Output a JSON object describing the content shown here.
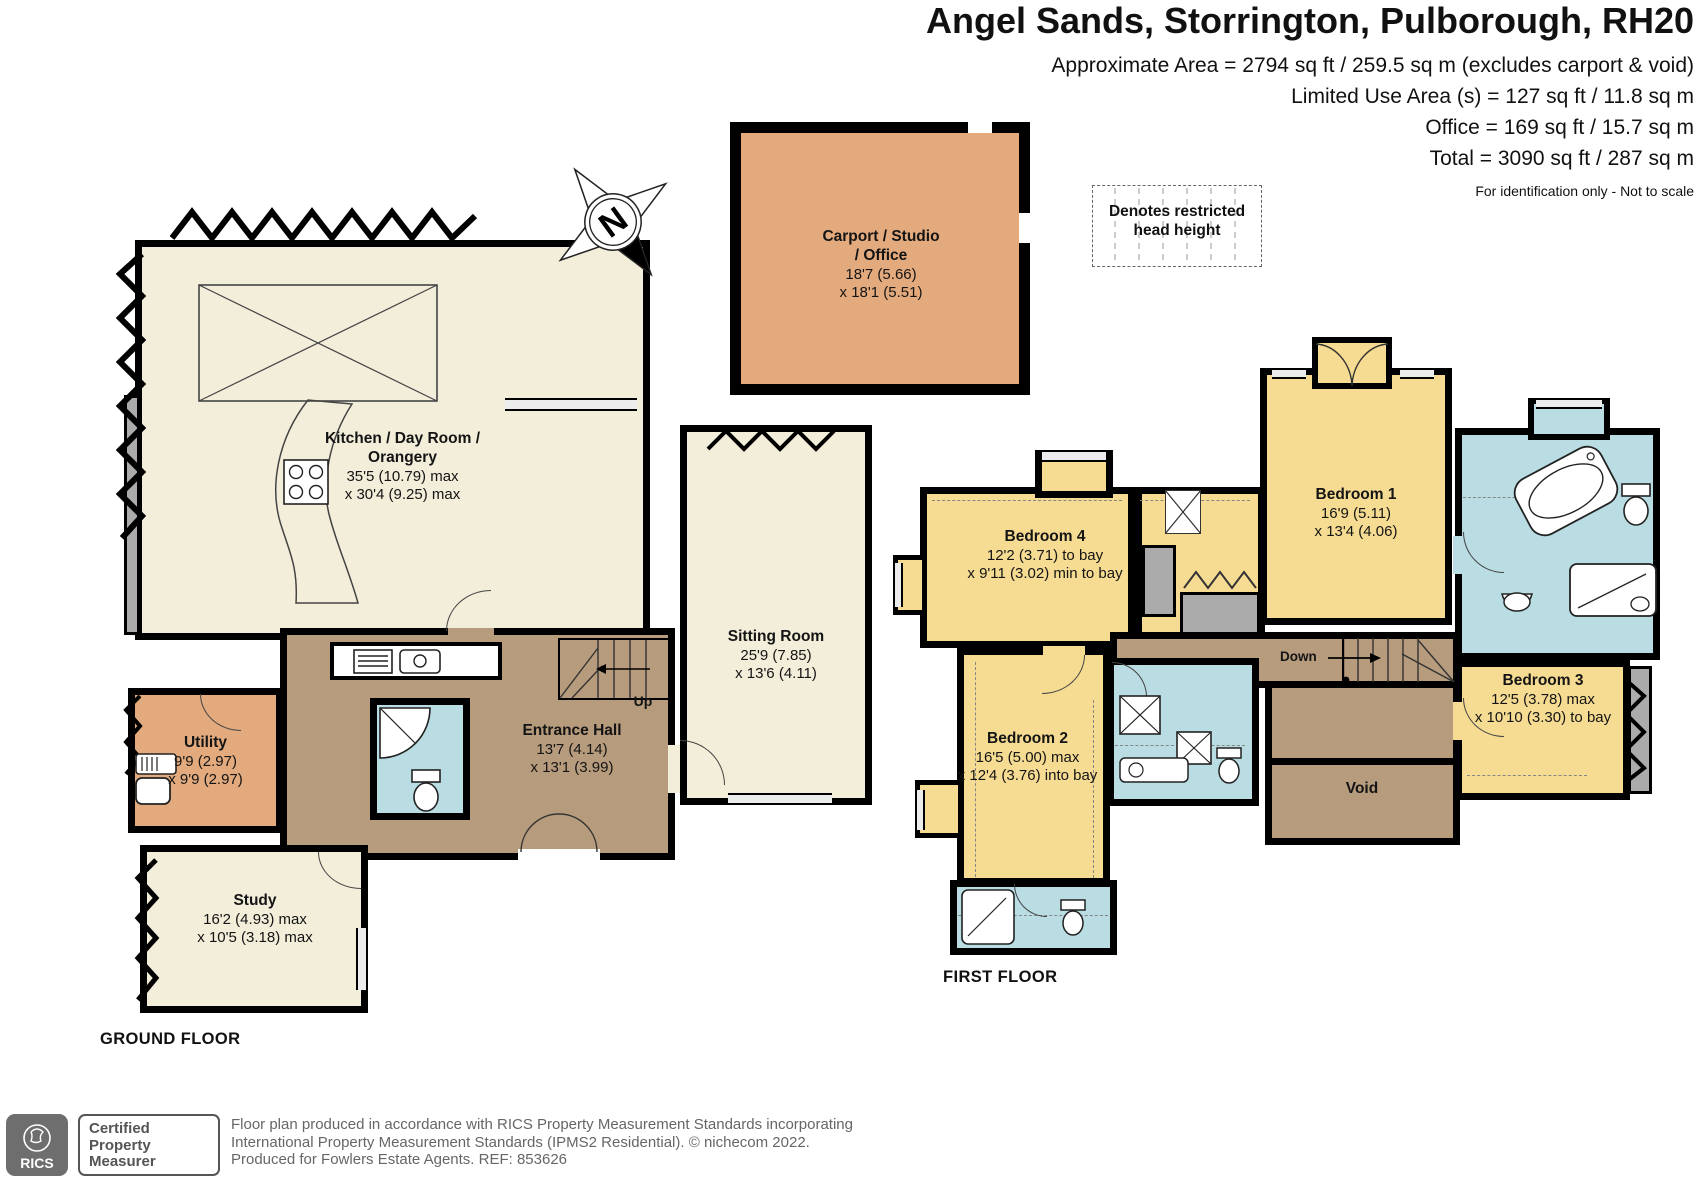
{
  "header": {
    "title": "Angel Sands, Storrington, Pulborough, RH20",
    "area_line1": "Approximate Area = 2794 sq ft / 259.5 sq m (excludes carport & void)",
    "area_line2": "Limited Use Area (s) = 127 sq ft / 11.8 sq m",
    "area_line3": "Office = 169 sq ft / 15.7 sq m",
    "area_line4": "Total = 3090 sq ft / 287 sq m",
    "note": "For identification only - Not to scale"
  },
  "legend": {
    "restricted": "Denotes restricted head height"
  },
  "compass": {
    "north": "N"
  },
  "outbuilding": {
    "carport": {
      "name": "Carport / Studio / Office",
      "dim1": "18'7 (5.66)",
      "dim2": "x 18'1 (5.51)"
    }
  },
  "ground_floor": {
    "label": "GROUND FLOOR",
    "kitchen": {
      "name": "Kitchen / Day Room / Orangery",
      "dim1": "35'5 (10.79) max",
      "dim2": "x 30'4 (9.25) max"
    },
    "sitting_room": {
      "name": "Sitting Room",
      "dim1": "25'9 (7.85)",
      "dim2": "x 13'6 (4.11)"
    },
    "entrance_hall": {
      "name": "Entrance Hall",
      "dim1": "13'7 (4.14)",
      "dim2": "x 13'1 (3.99)"
    },
    "utility": {
      "name": "Utility",
      "dim1": "9'9 (2.97)",
      "dim2": "x 9'9 (2.97)"
    },
    "study": {
      "name": "Study",
      "dim1": "16'2 (4.93) max",
      "dim2": "x 10'5 (3.18) max"
    },
    "stairs_up": "Up"
  },
  "first_floor": {
    "label": "FIRST FLOOR",
    "bedroom1": {
      "name": "Bedroom 1",
      "dim1": "16'9 (5.11)",
      "dim2": "x 13'4 (4.06)"
    },
    "bedroom2": {
      "name": "Bedroom 2",
      "dim1": "16'5 (5.00) max",
      "dim2": "x 12'4 (3.76) into bay"
    },
    "bedroom3": {
      "name": "Bedroom 3",
      "dim1": "12'5 (3.78) max",
      "dim2": "x 10'10 (3.30) to bay"
    },
    "bedroom4": {
      "name": "Bedroom 4",
      "dim1": "12'2 (3.71) to bay",
      "dim2": "x 9'11 (3.02) min to bay"
    },
    "void": "Void",
    "stairs_down": "Down"
  },
  "footer": {
    "rics": "RICS",
    "badge": "Certified Property Measurer",
    "line1": "Floor plan produced in accordance with RICS Property Measurement Standards incorporating",
    "line2": "International Property Measurement Standards (IPMS2 Residential).    © nichecom 2022.",
    "line3": "Produced for Fowlers Estate Agents.    REF:  853626"
  },
  "colors": {
    "room_cream": "#f2eeda",
    "bedroom_yellow": "#f6dc93",
    "utility_orange": "#e3aa7d",
    "hall_brown": "#b69b7c",
    "bath_blue": "#b9dde3",
    "wall_black": "#000000",
    "feature_gray": "#ababab"
  }
}
